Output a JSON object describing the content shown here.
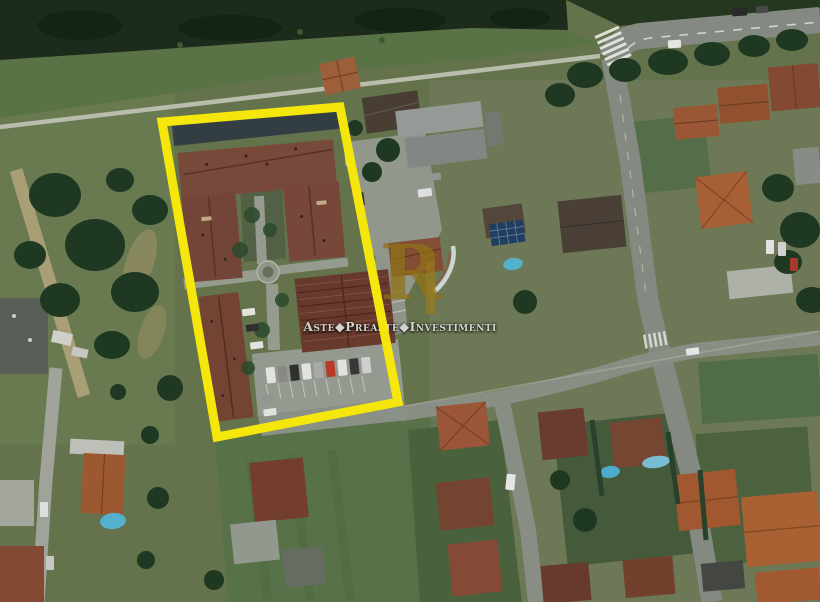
{
  "watermark": {
    "logo_letter": "R",
    "brand_text": "Aste◆Preaste◆Investimenti",
    "logo_color": "#9e7c1b",
    "text_color": "#d2d2ce"
  },
  "highlight": {
    "border_color": "#f5e70c"
  }
}
